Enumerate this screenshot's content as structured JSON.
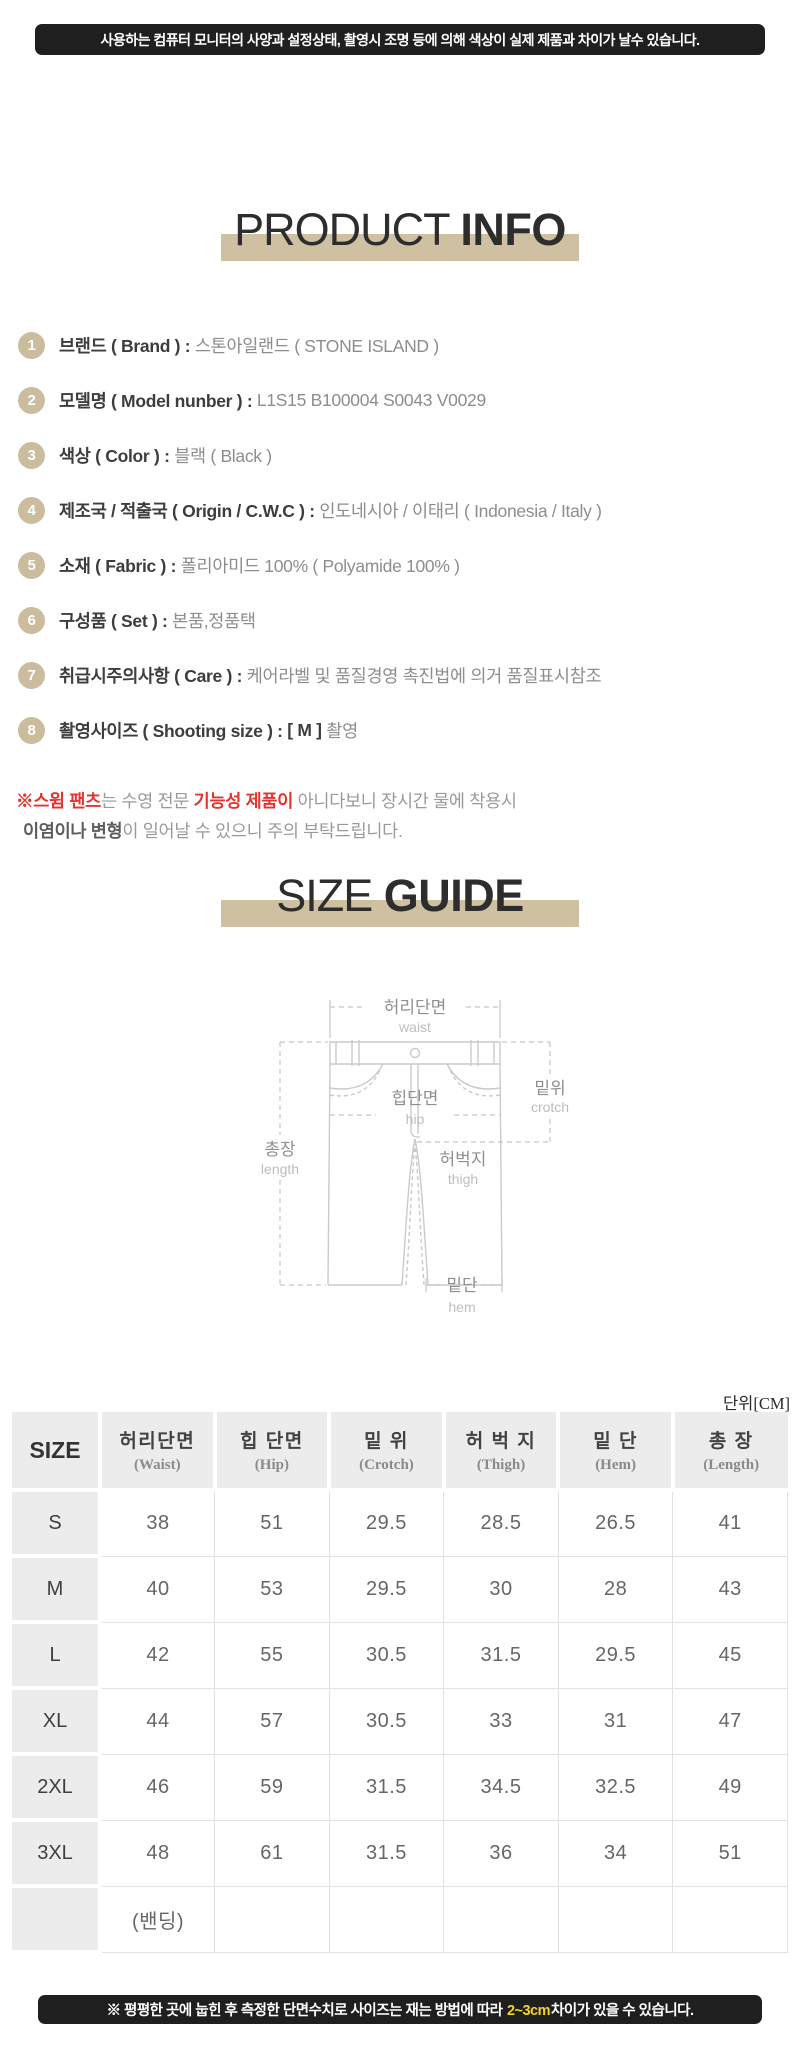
{
  "colors": {
    "tan_band": "#cfc0a2",
    "tan_circle": "#cbbc9e",
    "banner_bg": "#1f1f1f",
    "yellow_highlight": "#f5d32b",
    "warning_red": "#e4342e"
  },
  "banners": {
    "top": "사용하는 컴퓨터 모니터의 사양과 설정상태, 촬영시 조명 등에 의해 색상이 실제 제품과 차이가 날수 있습니다.",
    "bottom_pre": "※ 평평한 곳에 눕힌 후 측정한 단면수치로 사이즈는 재는 방법에 따라 ",
    "bottom_highlight": "2~3cm",
    "bottom_post": "차이가 있을 수 있습니다."
  },
  "product_info": {
    "title_light": "PRODUCT ",
    "title_bold": "INFO",
    "items": [
      {
        "num": "1",
        "label": "브랜드 ( Brand ) : ",
        "value": "스톤아일랜드 ( STONE ISLAND )"
      },
      {
        "num": "2",
        "label": "모델명 ( Model nunber ) : ",
        "value": "L1S15 B100004 S0043 V0029"
      },
      {
        "num": "3",
        "label": "색상 ( Color ) : ",
        "value": "블랙 ( Black )"
      },
      {
        "num": "4",
        "label": "제조국 / 적출국 ( Origin / C.W.C ) : ",
        "value": "인도네시아 / 이태리 ( Indonesia / Italy )"
      },
      {
        "num": "5",
        "label": "소재 ( Fabric ) : ",
        "value": "폴리아미드 100% ( Polyamide 100% )"
      },
      {
        "num": "6",
        "label": "구성품 ( Set ) : ",
        "value": "본품,정품택"
      },
      {
        "num": "7",
        "label": "취급시주의사항 ( Care ) : ",
        "value": "케어라벨 및 품질경영 촉진법에 의거 품질표시참조"
      },
      {
        "num": "8",
        "label": "촬영사이즈 ( Shooting size ) : ",
        "value_dark": "[ M ] ",
        "value": "촬영"
      }
    ],
    "warning": {
      "l1_red1": "※스윔 팬츠",
      "l1_gray1": "는 수영 전문 ",
      "l1_red2": "기능성 제품이",
      "l1_gray2": " 아니다보니 장시간 물에 착용시",
      "l2_dark": "이염이나 변형",
      "l2_gray": "이 일어날 수 있으니 주의 부탁드립니다."
    }
  },
  "size_guide": {
    "title_light": "SIZE ",
    "title_bold": "GUIDE",
    "diagram": {
      "waist_ko": "허리단면",
      "waist_en": "waist",
      "hip_ko": "힙단면",
      "hip_en": "hip",
      "crotch_ko": "밑위",
      "crotch_en": "crotch",
      "length_ko": "총장",
      "length_en": "length",
      "thigh_ko": "허벅지",
      "thigh_en": "thigh",
      "hem_ko": "밑단",
      "hem_en": "hem"
    },
    "unit": "단위[CM]",
    "table": {
      "size_header": "SIZE",
      "columns": [
        {
          "ko": "허리단면",
          "en": "(Waist)"
        },
        {
          "ko": "힙 단면",
          "en": "(Hip)"
        },
        {
          "ko": "밑 위",
          "en": "(Crotch)"
        },
        {
          "ko": "허 벅 지",
          "en": "(Thigh)"
        },
        {
          "ko": "밑 단",
          "en": "(Hem)"
        },
        {
          "ko": "총 장",
          "en": "(Length)"
        }
      ],
      "rows": [
        {
          "size": "S",
          "values": [
            "38",
            "51",
            "29.5",
            "28.5",
            "26.5",
            "41"
          ]
        },
        {
          "size": "M",
          "values": [
            "40",
            "53",
            "29.5",
            "30",
            "28",
            "43"
          ]
        },
        {
          "size": "L",
          "values": [
            "42",
            "55",
            "30.5",
            "31.5",
            "29.5",
            "45"
          ]
        },
        {
          "size": "XL",
          "values": [
            "44",
            "57",
            "30.5",
            "33",
            "31",
            "47"
          ]
        },
        {
          "size": "2XL",
          "values": [
            "46",
            "59",
            "31.5",
            "34.5",
            "32.5",
            "49"
          ]
        },
        {
          "size": "3XL",
          "values": [
            "48",
            "61",
            "31.5",
            "36",
            "34",
            "51"
          ]
        },
        {
          "size": "",
          "values": [
            "(밴딩)",
            "",
            "",
            "",
            "",
            ""
          ]
        }
      ]
    }
  }
}
